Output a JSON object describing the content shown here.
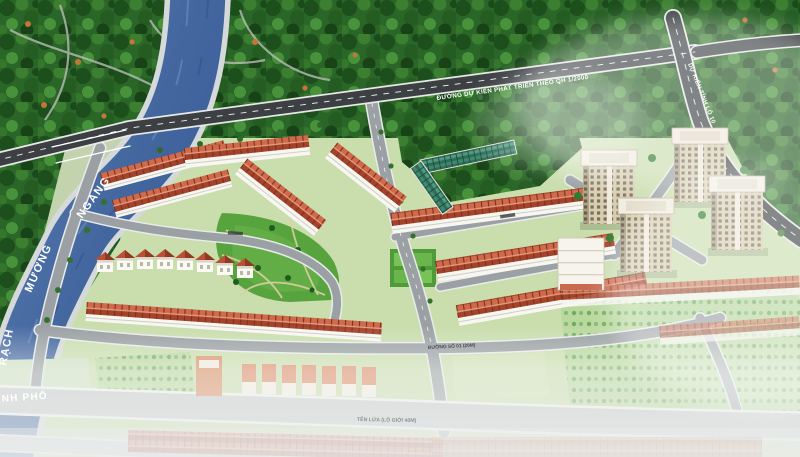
{
  "map": {
    "canal": {
      "rach": "RẠCH",
      "muong": "MƯƠNG",
      "ngang": "NGANG"
    },
    "roads": {
      "planned_main": "ĐƯỜNG DỰ KIẾN PHÁT TRIỂN THEO QH 1/2000",
      "provincial_10": "DỰ KIẾN TỈNH LỘ 10",
      "street_no": "ĐƯỜNG SỐ 01 (20M)",
      "ten_lua": "TÊN LỬA (LỘ GIỚI 40M)",
      "city_partial": "NH PHỐ"
    },
    "colors": {
      "water": "#4a6ea8",
      "roof": "#bb5437",
      "canopy": "#2a6627",
      "road_dark": "#3c4043",
      "tower": "#d8cbb0"
    }
  }
}
